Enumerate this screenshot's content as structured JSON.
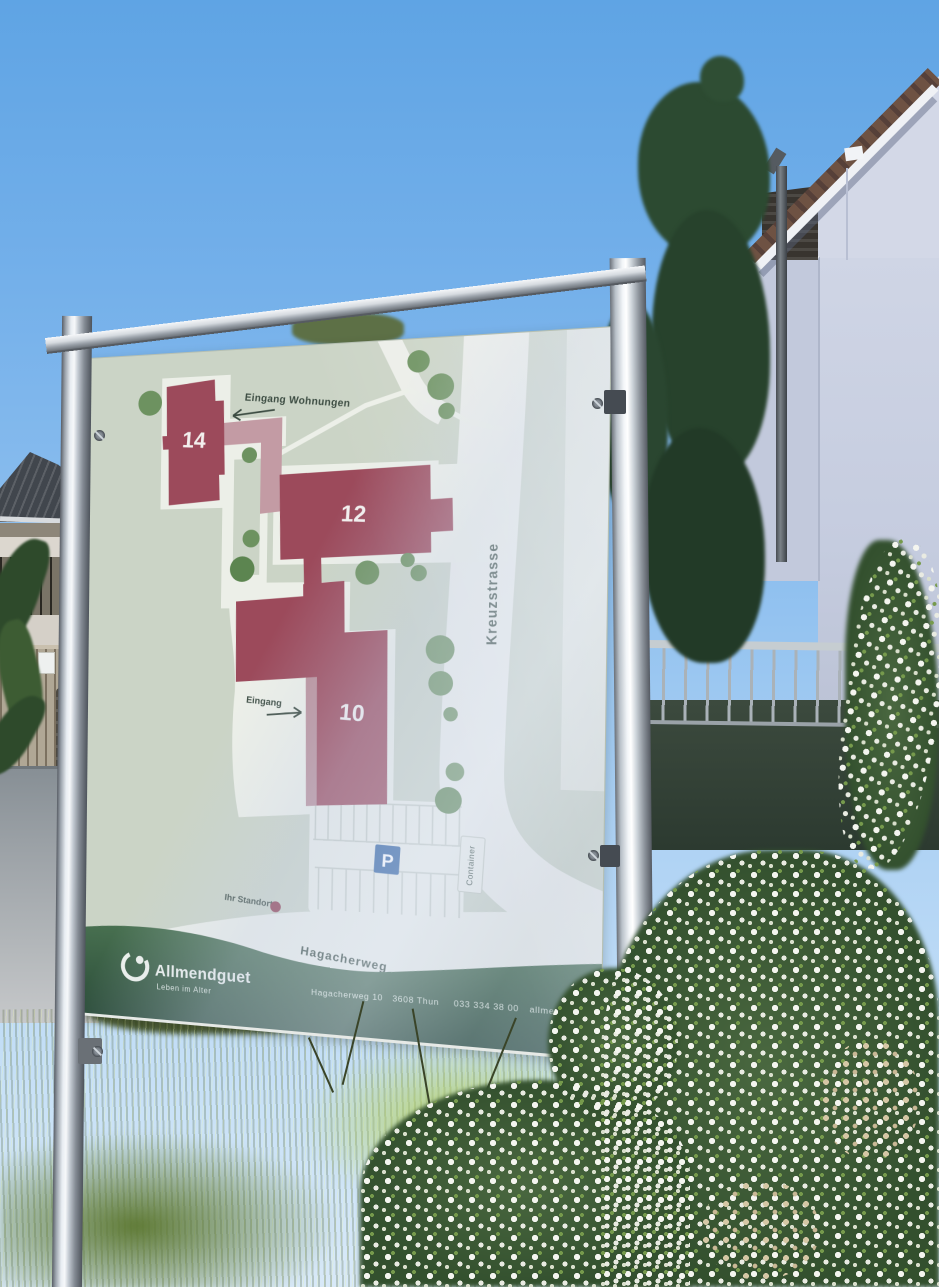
{
  "sign": {
    "map": {
      "labels": {
        "entrance_apartments": "Eingang Wohnungen",
        "entrance": "Eingang",
        "street_right": "Kreuzstrasse",
        "street_bottom": "Hagacherweg",
        "parking": "P",
        "container": "Container",
        "your_location": "Ihr Standort"
      },
      "buildings": [
        {
          "number": "14"
        },
        {
          "number": "12"
        },
        {
          "number": "10"
        }
      ]
    },
    "brand": {
      "name": "Allmendguet",
      "tagline": "Leben im Alter"
    },
    "footer": {
      "address": "Hagacherweg 10",
      "city": "3608 Thun",
      "phone": "033 334 38 00",
      "website": "allmendguet.ch"
    },
    "colors": {
      "building": "#9c4a5b",
      "building_light": "#c39ba4",
      "lawn": "#cbd4c6",
      "path_white": "#ecefe8",
      "tree_green": "#6d9260",
      "band_green": "#3a5f47",
      "parking_blue": "#2d5f9e",
      "location_dot": "#8e3b4c",
      "label_dark": "#3c4c42"
    }
  }
}
